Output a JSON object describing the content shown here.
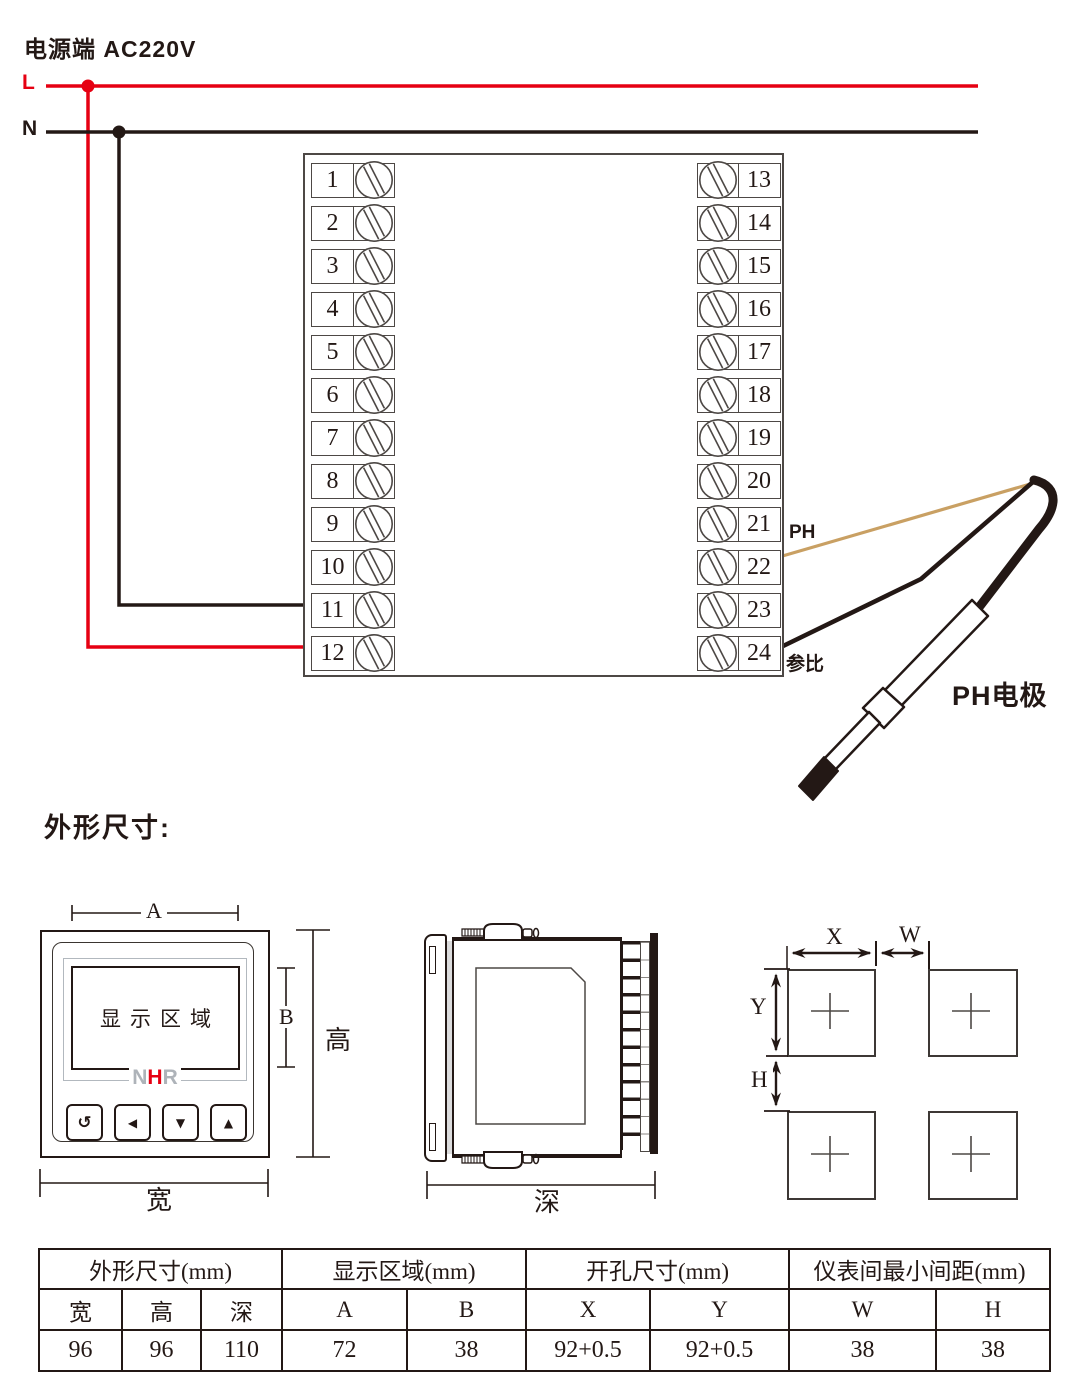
{
  "colors": {
    "red": "#e60012",
    "ink": "#231815",
    "tan": "#c9a063",
    "line_gray": "#4d4845",
    "gray_border": "#b2b8be",
    "logo_gray": "#aeb3b9",
    "shadow": "#dcdcdd"
  },
  "power": {
    "title": "电源端  AC220V",
    "l_label": "L",
    "n_label": "N"
  },
  "terminal_block": {
    "left": [
      "1",
      "2",
      "3",
      "4",
      "5",
      "6",
      "7",
      "8",
      "9",
      "10",
      "11",
      "12"
    ],
    "right": [
      "13",
      "14",
      "15",
      "16",
      "17",
      "18",
      "19",
      "20",
      "21",
      "22",
      "23",
      "24"
    ]
  },
  "electrode": {
    "ph_wire_label": "PH",
    "reference_wire_label": "参比",
    "name": "PH电极"
  },
  "outline_section": {
    "heading": "外形尺寸:"
  },
  "front_view": {
    "display_area_text": "显示区域",
    "logo": [
      {
        "ch": "N",
        "color": "gray"
      },
      {
        "ch": "H",
        "color": "red"
      },
      {
        "ch": "R",
        "color": "gray"
      }
    ],
    "buttons": [
      {
        "name": "cycle",
        "glyph": "↺"
      },
      {
        "name": "left",
        "glyph": "◀"
      },
      {
        "name": "down",
        "glyph": "▼"
      },
      {
        "name": "up",
        "glyph": "▲"
      }
    ],
    "dims": {
      "a": "A",
      "b": "B",
      "height": "高",
      "width": "宽"
    }
  },
  "side_view": {
    "dims": {
      "depth": "深"
    }
  },
  "cutout_view": {
    "dims": {
      "x": "X",
      "w": "W",
      "y": "Y",
      "h": "H"
    }
  },
  "spec_table": {
    "groups": [
      {
        "label": "外形尺寸(mm)",
        "span": 3
      },
      {
        "label": "显示区域(mm)",
        "span": 2
      },
      {
        "label": "开孔尺寸(mm)",
        "span": 2
      },
      {
        "label": "仪表间最小间距(mm)",
        "span": 2
      }
    ],
    "sub_headers": [
      "宽",
      "高",
      "深",
      "A",
      "B",
      "X",
      "Y",
      "W",
      "H"
    ],
    "values": [
      "96",
      "96",
      "110",
      "72",
      "38",
      "92+0.5",
      "92+0.5",
      "38",
      "38"
    ]
  }
}
